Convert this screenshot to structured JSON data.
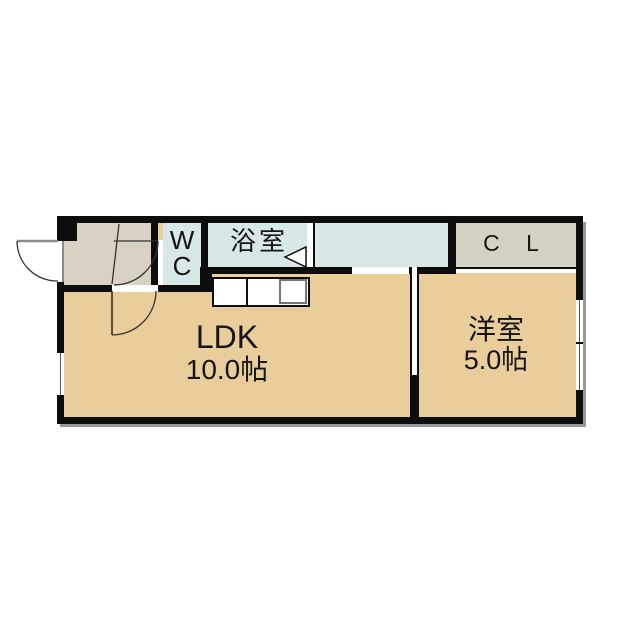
{
  "floorplan": {
    "rooms": {
      "wc": {
        "line1": "W",
        "line2": "C"
      },
      "bathroom": {
        "label": "浴室"
      },
      "closet": {
        "label": "C L"
      },
      "ldk": {
        "name": "LDK",
        "size": "10.0帖"
      },
      "western_room": {
        "name": "洋室",
        "size": "5.0帖"
      }
    }
  },
  "colors": {
    "wall": "#0d0d0d",
    "room_fill": "#E9CE9B",
    "wet_area_fill": "#D8E8E9",
    "entrance_fill": "#D7D2C4",
    "closet_fill": "#D6D2C3",
    "shadow": "#999999",
    "background": "#FFFFFF"
  }
}
